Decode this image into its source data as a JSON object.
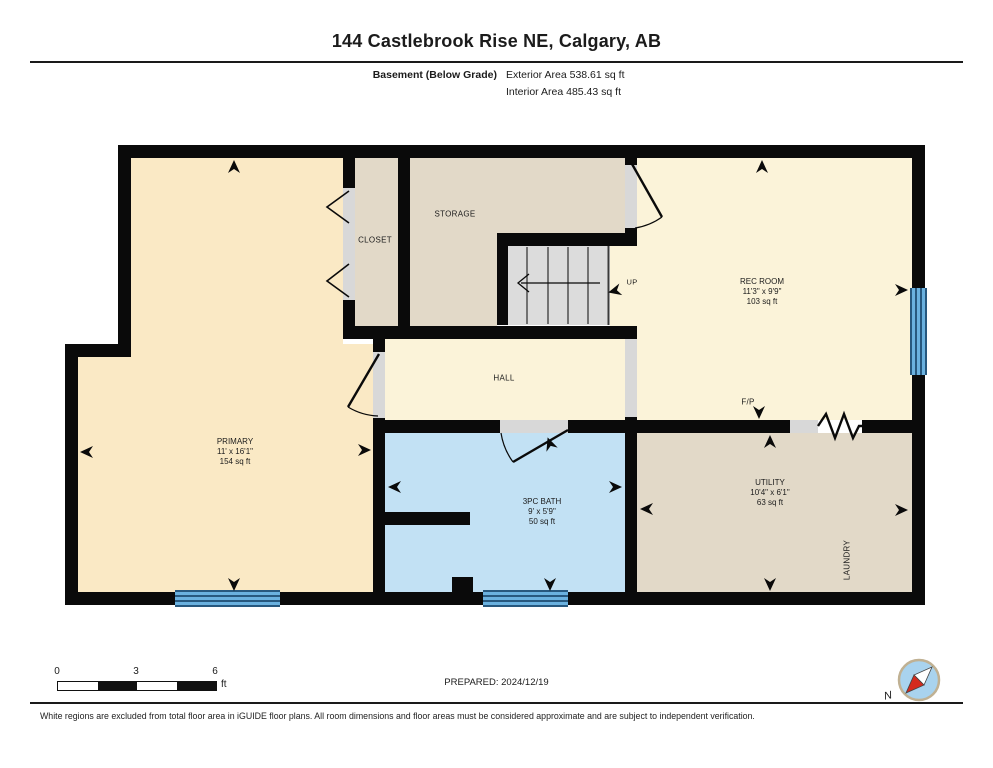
{
  "header": {
    "title": "144 Castlebrook Rise NE, Calgary, AB",
    "floor_label": "Basement (Below Grade)",
    "exterior_area": "Exterior Area 538.61 sq ft",
    "interior_area": "Interior Area 485.43 sq ft"
  },
  "rooms": {
    "primary": {
      "name": "PRIMARY",
      "dims": "11' x 16'1\"",
      "area": "154 sq ft"
    },
    "rec_room": {
      "name": "REC ROOM",
      "dims": "11'3\" x 9'9\"",
      "area": "103 sq ft"
    },
    "bath": {
      "name": "3PC BATH",
      "dims": "9' x 5'9\"",
      "area": "50 sq ft"
    },
    "utility": {
      "name": "UTILITY",
      "dims": "10'4\" x 6'1\"",
      "area": "63 sq ft"
    },
    "storage": {
      "name": "STORAGE"
    },
    "closet": {
      "name": "CLOSET"
    },
    "hall": {
      "name": "HALL"
    },
    "laundry": {
      "name": "LAUNDRY"
    }
  },
  "plan_labels": {
    "stairs_up": "UP",
    "fireplace": "F/P"
  },
  "footer": {
    "scale": {
      "ticks": [
        "0",
        "3",
        "6"
      ],
      "unit": "ft"
    },
    "prepared": "PREPARED: 2024/12/19",
    "compass_label": "N",
    "disclaimer": "White regions are excluded from total floor area in iGUIDE floor plans. All room dimensions and floor areas must be considered approximate and are subject to independent verification."
  },
  "icons": {
    "compass": "compass-needle-icon",
    "stairs_direction": "left-arrow-icon",
    "dimension_marker": "concave-arrow-icon",
    "fireplace_symbol": "zigzag-icon",
    "door_swing": "quarter-arc-icon",
    "bifold_door": "chevron-icon"
  },
  "colors": {
    "room_peach": "#FAE9C5",
    "room_cream": "#FBF3D9",
    "room_beige": "#E2D9C8",
    "room_blue": "#C2E1F4",
    "stairs_gray": "#DCDCDC",
    "threshold_gray": "#D8D8D8",
    "window_fill": "#6AB1DF",
    "window_line": "#27587E",
    "wall_black": "#0A0A0A",
    "compass_fill": "#A9D3EE",
    "compass_ring": "#C0B193",
    "needle_red": "#D42B1E"
  }
}
